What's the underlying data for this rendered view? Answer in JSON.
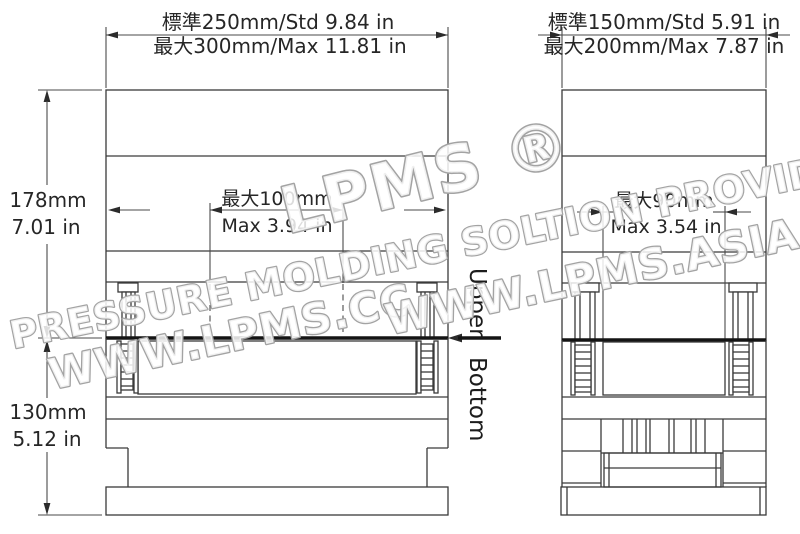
{
  "drawing": {
    "front_view": {
      "top_dim_std": "標準250mm/Std 9.84 in",
      "top_dim_max": "最大300mm/Max 11.81 in",
      "upper_height_mm": "178mm",
      "upper_height_in": "7.01 in",
      "lower_height_mm": "130mm",
      "lower_height_in": "5.12 in",
      "cavity_max_mm": "最大100mm",
      "cavity_max_in": "Max 3.94 in"
    },
    "side_view": {
      "top_dim_std": "標準150mm/Std 5.91 in",
      "top_dim_max": "最大200mm/Max 7.87 in",
      "cavity_max_mm": "最大90mm",
      "cavity_max_in": "Max 3.54 in"
    },
    "parting_line": {
      "upper_label": "Upper",
      "bottom_label": "Bottom"
    },
    "watermark": {
      "brand": "LPMS ®",
      "tagline": "LOW PRESSURE MOLDING SOLTION PROVIDER",
      "website_cc": "WWW.LPMS.CC",
      "website_asia": "WWW.LPMS.ASIA"
    },
    "colors": {
      "background": "#ffffff",
      "line": "#3a3a3a",
      "parting_line": "#141414",
      "text": "#262626",
      "watermark_outline": "#a3a3a3"
    }
  }
}
